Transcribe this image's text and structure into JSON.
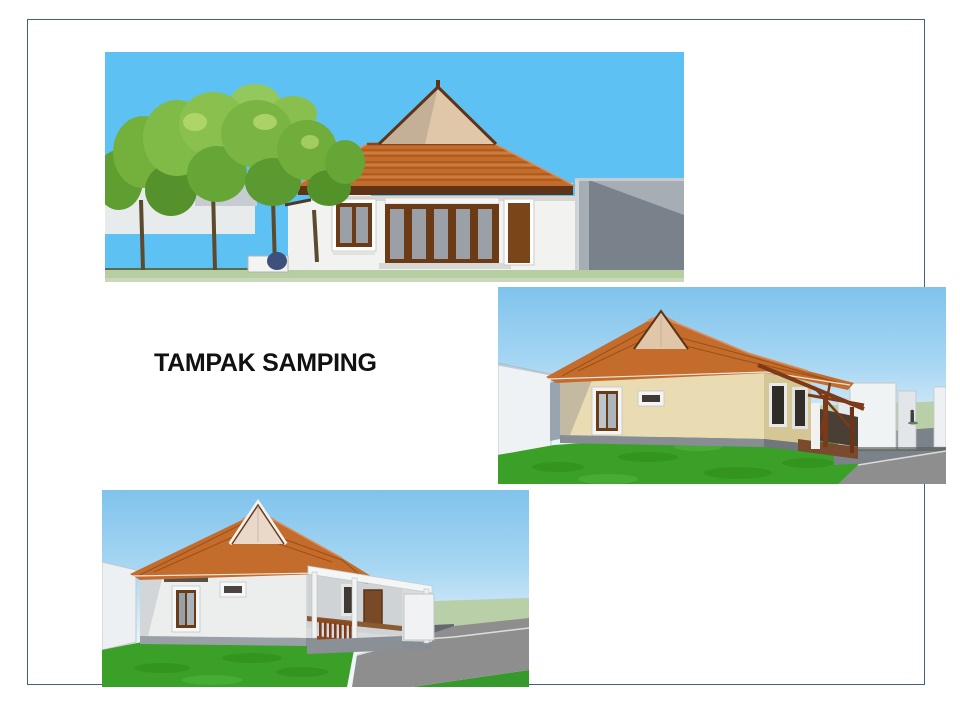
{
  "slide": {
    "title": "TAMPAK SAMPING",
    "title_color": "#111111",
    "border_color": "#44607a",
    "background": "#ffffff"
  },
  "figures": [
    {
      "name": "side-elevation-rendering",
      "label": "house side elevation rendering with trees and gray fence"
    },
    {
      "name": "perspective-rendering-right",
      "label": "3D perspective rendering of house, right side"
    },
    {
      "name": "perspective-rendering-left",
      "label": "3D perspective rendering of house, bottom left"
    }
  ],
  "palette": {
    "sky_flat": "#5ec1f3",
    "sky_top": "#7fc3ec",
    "sky_bottom": "#f3f9fd",
    "roof": "#c46c2c",
    "roof_line": "#9c4f16",
    "roof_highlight": "#d98f5d",
    "gable": "#e0c7a9",
    "trim_brown": "#5f3317",
    "wall_white": "#f2f3f1",
    "wall_light": "#eceeee",
    "wall_light_shade": "#d9dcde",
    "wall_cream": "#e9dcb2",
    "wall_cream_shade": "#d5c795",
    "plinth_gray": "#878d93",
    "fence_gray": "#a6adb4",
    "fence_gray_dark": "#79818a",
    "grass": "#3aa028",
    "grass_dark": "#2e8a1a",
    "field_pale": "#b8cfa7",
    "paving": "#8e8e8e",
    "ground_strip": "#b7cda2",
    "timber": "#7c3a18",
    "window_frame": "#6b3a16",
    "glass_gray": "#9aa0a6"
  }
}
